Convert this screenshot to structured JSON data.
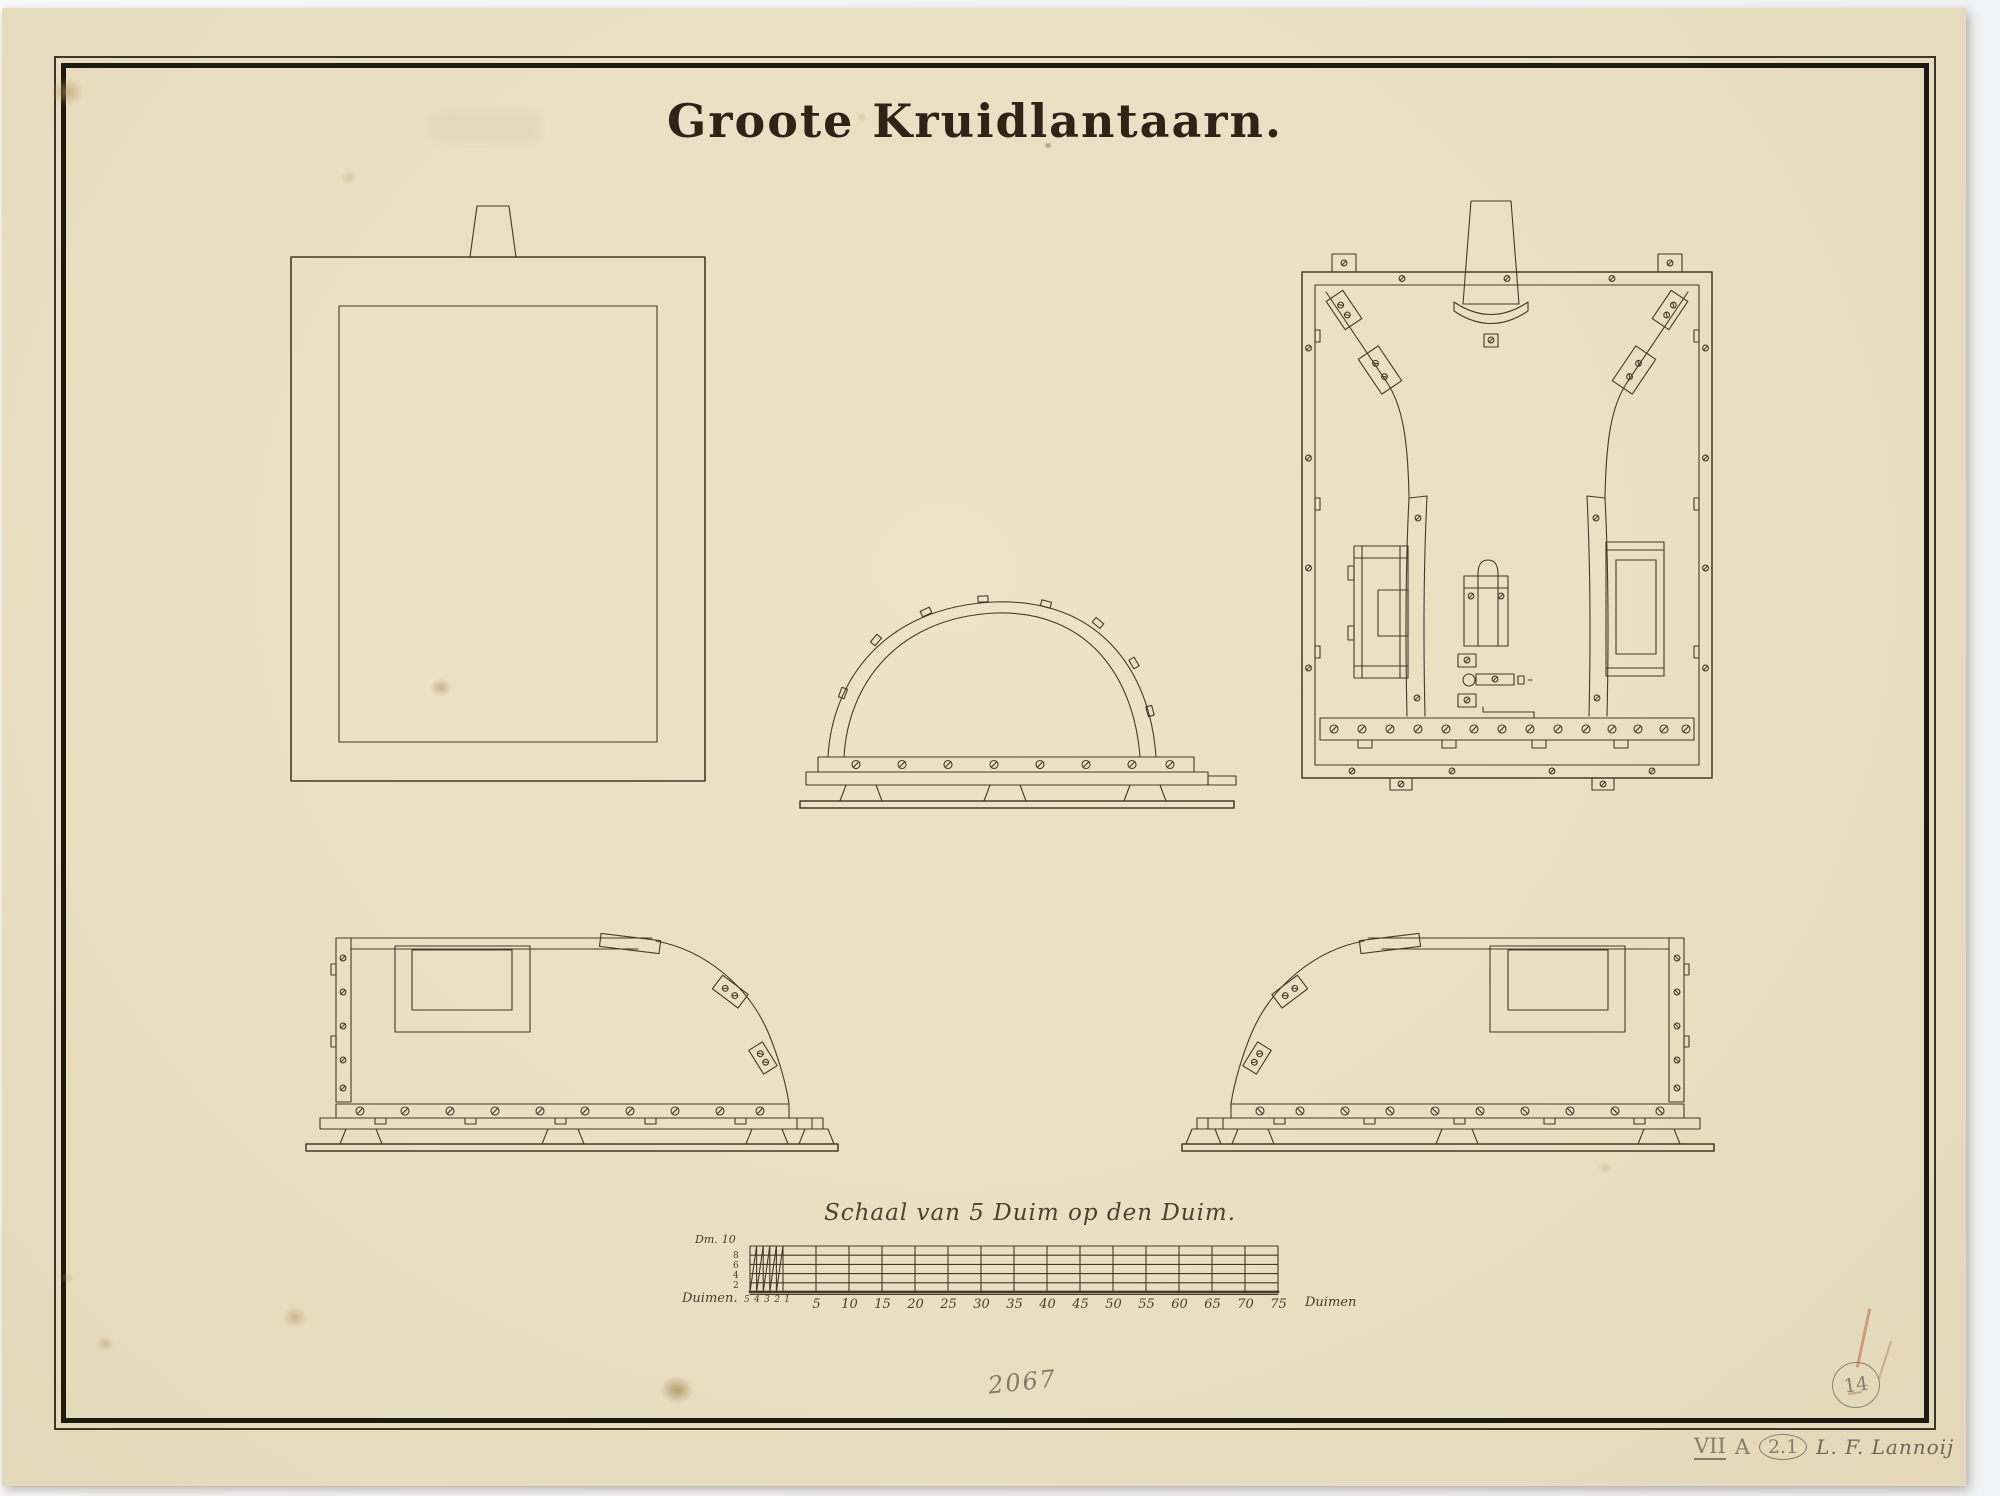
{
  "page": {
    "title": "Groote Kruidlantaarn.",
    "paper_color": "#eae1c6",
    "ink_color": "#453a2b",
    "pencil_color": "#837d6c"
  },
  "scale_bar": {
    "title": "Schaal van 5 Duim op den Duim.",
    "dm_label": "Dm.",
    "dm_top_value": "10",
    "left_row_values": [
      "8",
      "6",
      "4",
      "2"
    ],
    "unit_label_left": "Duimen.",
    "left_minor_ticks": [
      "5",
      "4",
      "3",
      "2",
      "1"
    ],
    "major_ticks": [
      "5",
      "10",
      "15",
      "20",
      "25",
      "30",
      "35",
      "40",
      "45",
      "50",
      "55",
      "60",
      "65",
      "70",
      "75"
    ],
    "unit_label_right": "Duimen"
  },
  "annotations": {
    "inventory_number": "2067",
    "sheet_number_circled": "14",
    "catalog_roman": "VII",
    "catalog_letter": "A",
    "catalog_circled": "2.1",
    "signature": "L. F. Lannoij"
  }
}
